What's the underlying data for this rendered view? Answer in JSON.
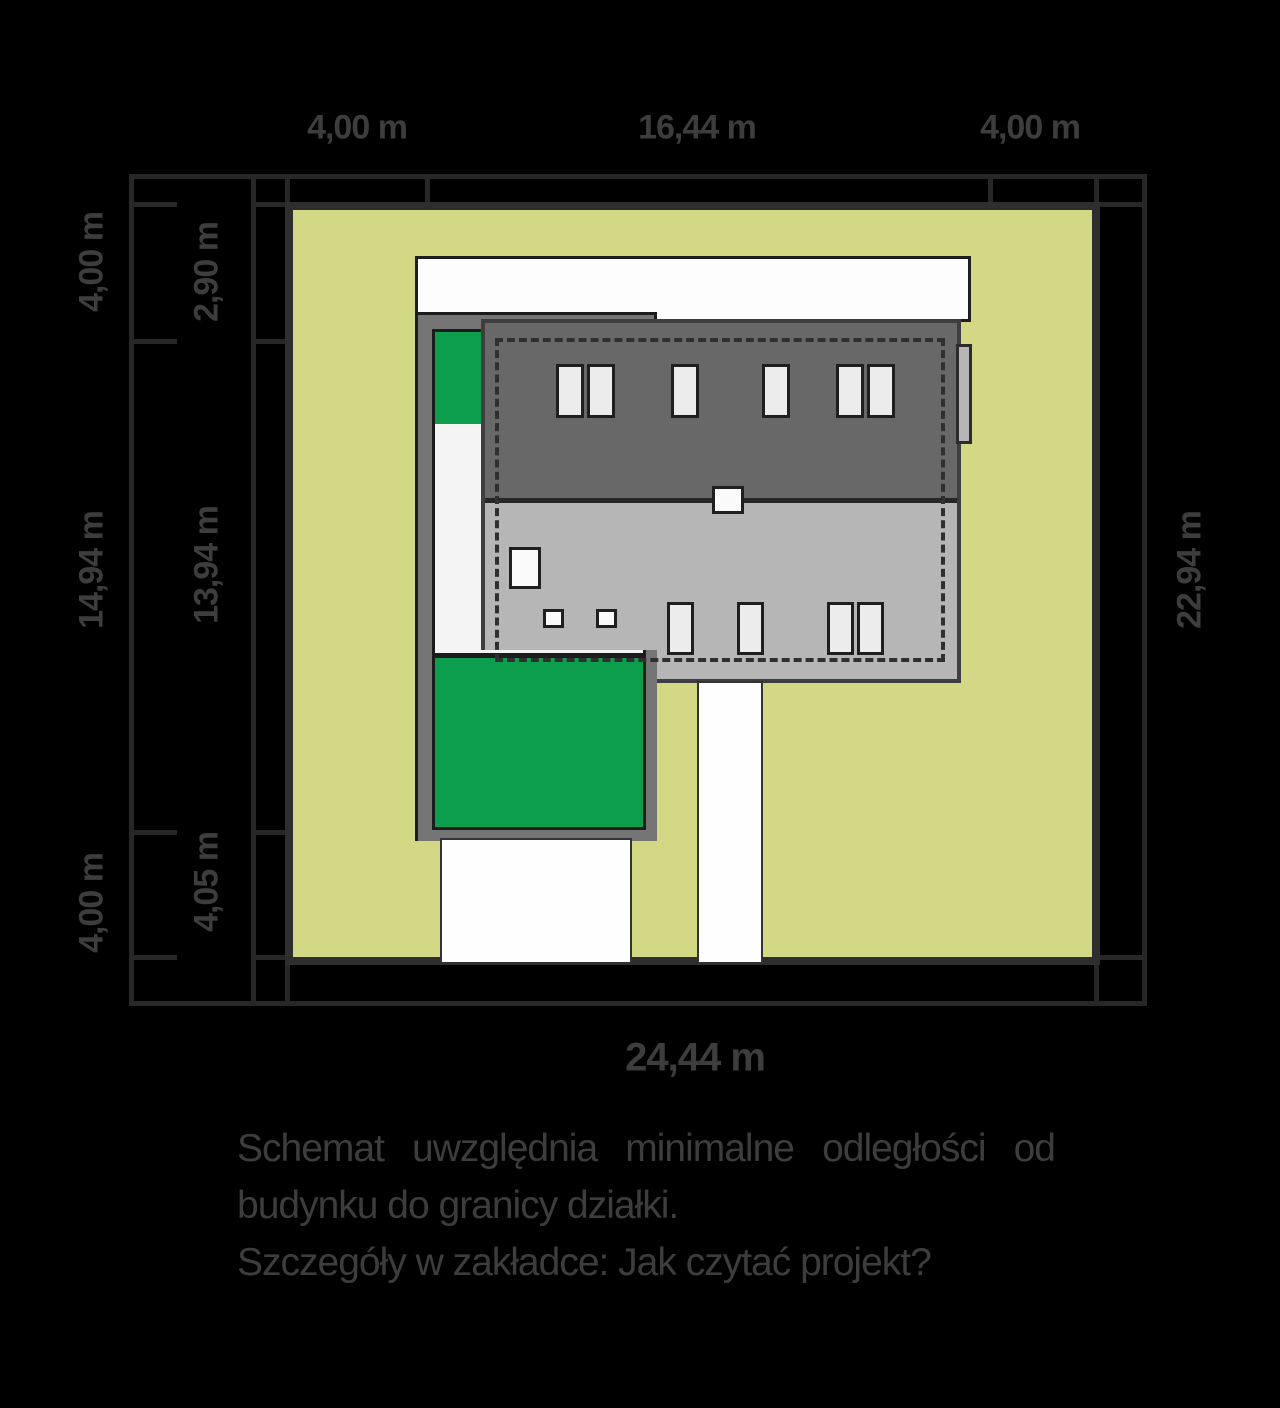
{
  "diagram": {
    "title": "site-plan-schematic",
    "dims": {
      "top": [
        "4,00 m",
        "16,44 m",
        "4,00 m"
      ],
      "left_outer": [
        "4,00 m",
        "14,94 m",
        "4,00 m"
      ],
      "left_inner": [
        "2,90 m",
        "13,94 m",
        "4,05 m"
      ],
      "right": "22,94 m",
      "bottom": "24,44 m"
    },
    "notes": {
      "line1": "Schemat uwzględnia minimalne odległości od",
      "line2": "budynku do granicy działki.",
      "line3": "Szczegóły w zakładce: Jak czytać projekt?"
    },
    "colors": {
      "background": "#000000",
      "plot_fill": "#d3d884",
      "plot_border": "#2e2e2e",
      "roof_upper": "#686868",
      "roof_lower": "#b6b6b6",
      "footprint_frame": "#757575",
      "garden_green": "#0c9d4d",
      "paving_white": "#fdfdfd",
      "dimension_text": "#3d3d3d"
    }
  }
}
